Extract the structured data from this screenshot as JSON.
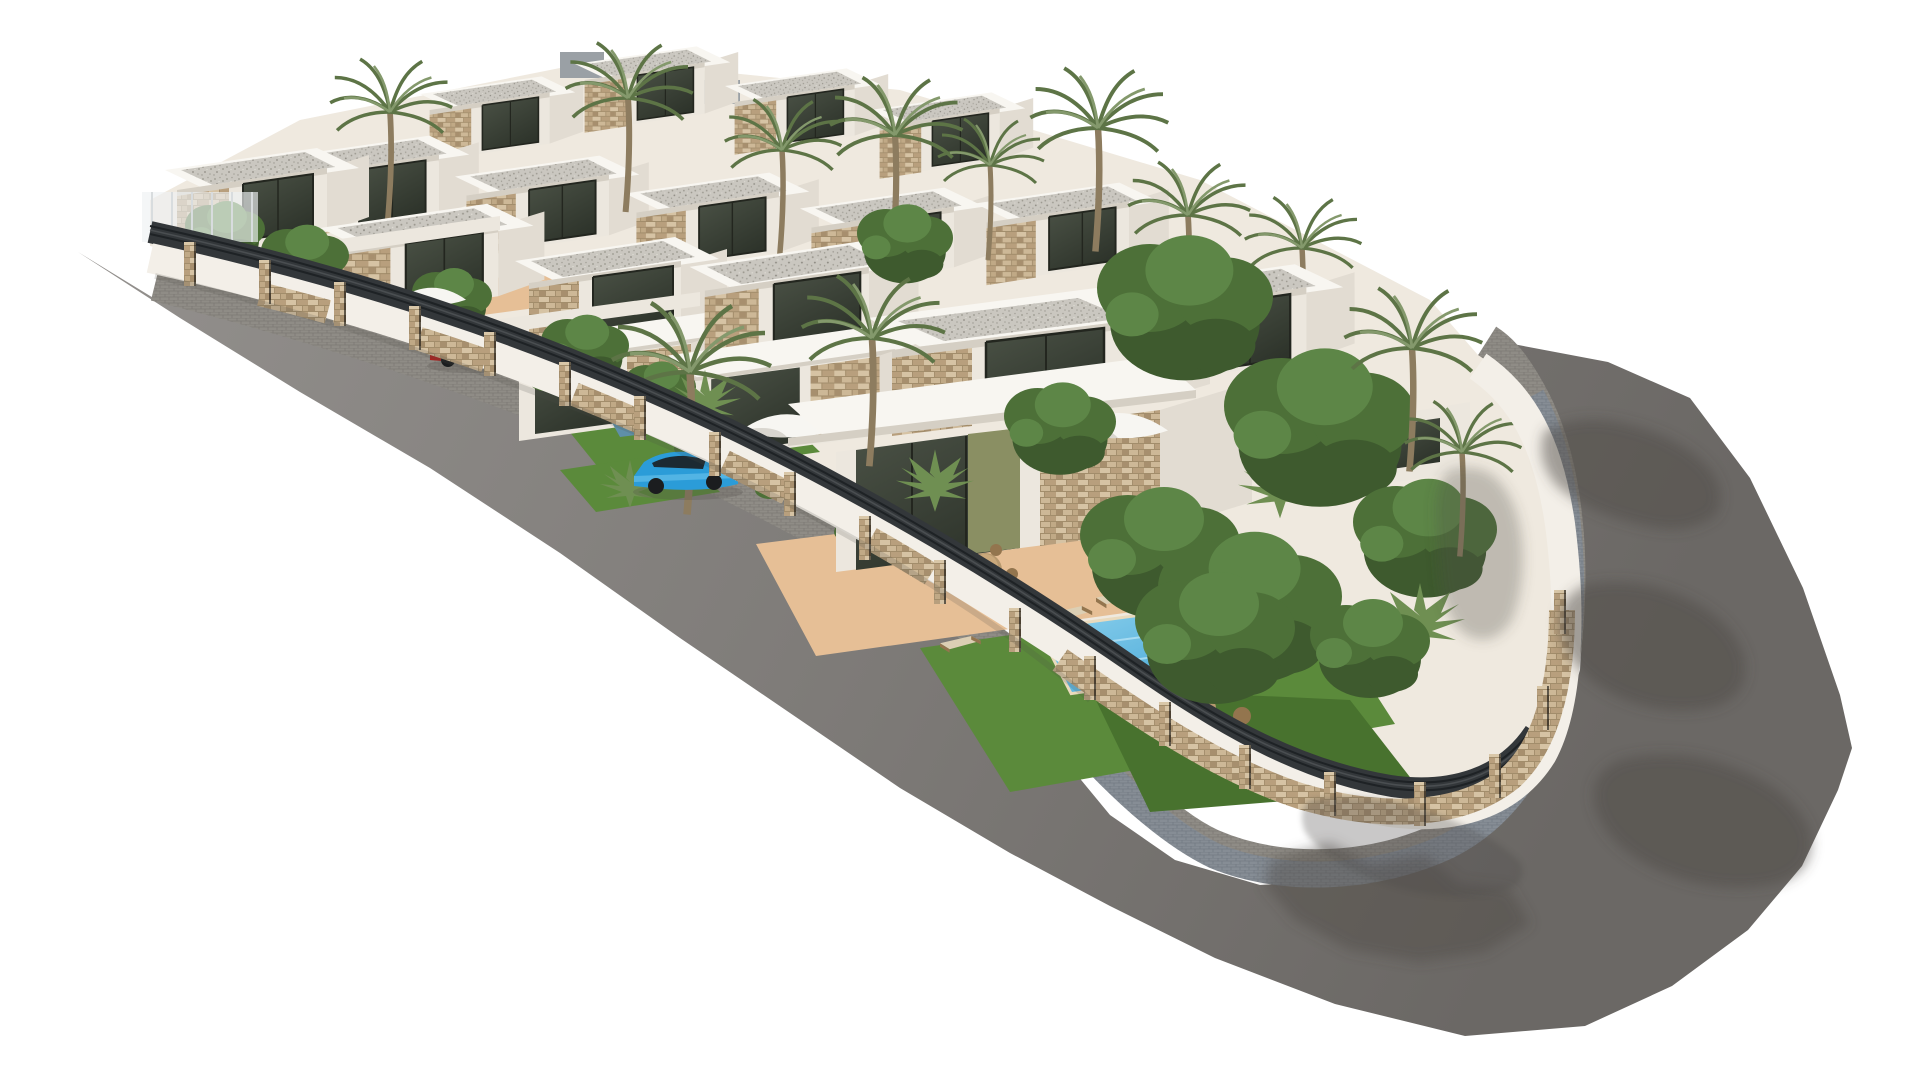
{
  "meta": {
    "title": "3D architectural rendering of a gated hillside villa development",
    "alt": "Aerial 3D render of a residential complex of modern white flat-roofed villas with stone accents, terraced down a slope inside a white-and-stone perimeter fence with dark slat panels, surrounded by a curving gray asphalt road with cobblestone sidewalk; palm trees, leafy trees, swimming pools, terracotta terraces, parasols, a red car and a blue car are visible; white background"
  },
  "scene": {
    "setting": "new-build villa development render on white backdrop, viewed from an elevated angle",
    "elements": [
      "asphalt road sweeping from upper left around the lower right corner",
      "cobblestone sidewalk following the perimeter wall",
      "perimeter wall: white stucco with stone pillars, stone base and dark horizontal slat fence panels",
      "terraced cluster of modern white villas with tan stone facade panels and dark glazing",
      "flat roofs with white parapets and gravel infill, some gray roofs",
      "tall palm trees and dense leafy trees, denser on the right side",
      "private gardens with lawns, terracotta terraces, swimming pools, dining sets, sun loungers, parasols and wicker furniture",
      "one red car and one blue car parked inside the fence",
      "tree and palm shadows cast on the road at the right"
    ],
    "counts": {
      "villas_visible": 15,
      "tall_palm_trees": 12,
      "leafy_trees": 11,
      "swimming_pools": 4,
      "parasols": 3,
      "cars": 2,
      "fence_pillars": 20
    },
    "cars": [
      {
        "color_name": "red",
        "hex": "#a82420"
      },
      {
        "color_name": "blue",
        "hex": "#2b9cd8"
      }
    ]
  },
  "palette": {
    "bg": "#ffffff",
    "roadLight": "#918e8b",
    "roadMid": "#7d7a77",
    "roadDark": "#6b6865",
    "curb": "#b1aea7",
    "cobbleBase": "#8f8c86",
    "cobbleJoint": "#7c7974",
    "cobbleBase2": "#868d95",
    "cobbleJoint2": "#737a83",
    "wallWhite": "#f3efe8",
    "whiteHi": "#f8f6f1",
    "whiteMd": "#ece7de",
    "whiteSh": "#d5cfc4",
    "whiteSide": "#e2dcd2",
    "stoneBase": "#c6b090",
    "stoneLight": "#d6c3a4",
    "stoneDark": "#a78f6e",
    "stoneJoint": "#97815f",
    "slat": "#33373a",
    "slatGap": "#1e2225",
    "slatHi": "#4a4e51",
    "roofGray": "#9aa0a5",
    "gravelBase": "#cac7c0",
    "gravelDot": "#9b988f",
    "glassTop": "#4b5246",
    "glassBottom": "#2e342b",
    "glassFrame": "#23261f",
    "interiorOlive": "#8a8f63",
    "terracotta": "#e6bf96",
    "grass": "#5b8a3b",
    "grassDark": "#48722e",
    "poolLight": "#8fd2ee",
    "poolDeep": "#3fa3d4",
    "poolCoping": "#e9dabd",
    "poolShade": "#5f8fa8",
    "trunk": "#8d7c5f",
    "palmGreen": "#5d7446",
    "palmLight": "#84996c",
    "fanPalm": "#6f8f52",
    "greenDark": "#3e5a2e",
    "green": "#4d7038",
    "greenLight": "#5d8647",
    "shadow": "#4e4b48",
    "carRed": "#a82420",
    "carRedDark": "#7e1a17",
    "carBlue": "#2b9cd8",
    "carBlueDark": "#1d7db2",
    "carGlass": "#1c2a33",
    "wheel": "#1b1d1f",
    "parasol": "#f7f6f2",
    "parasolShade": "#d9d6cf",
    "wood": "#b7996f",
    "woodDark": "#93754e",
    "loungerPale": "#dccfb4",
    "glassFence": "#eef1f2"
  }
}
